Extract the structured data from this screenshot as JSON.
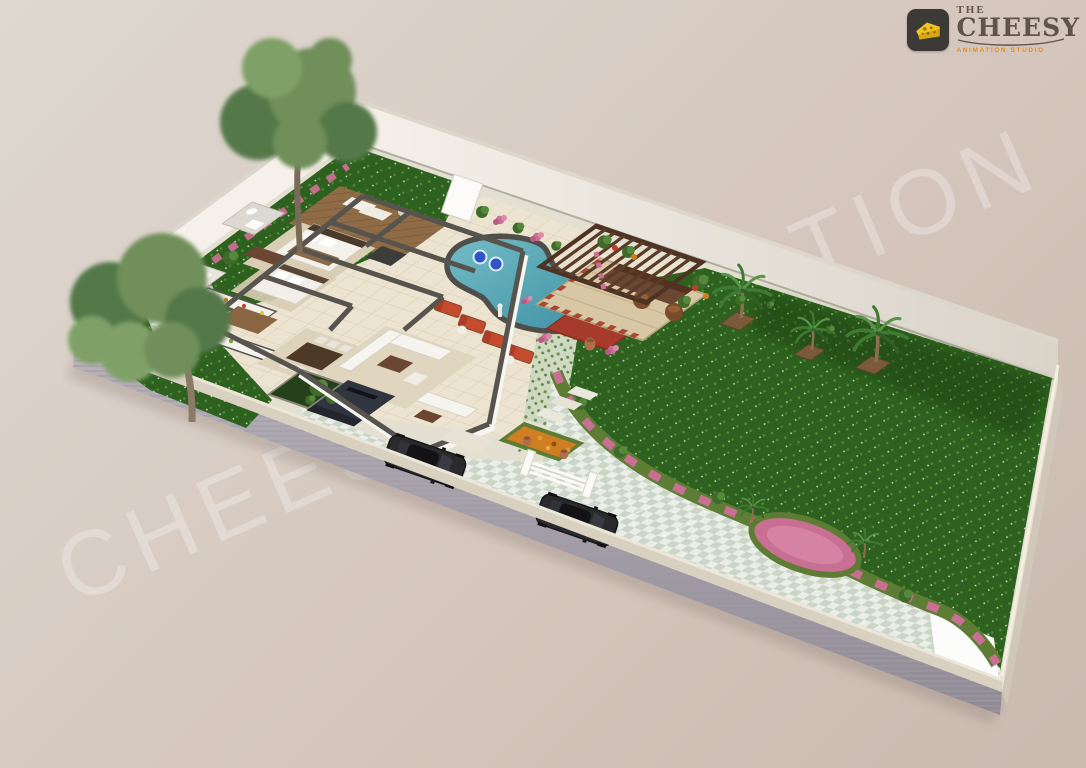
{
  "watermark": {
    "text": "CHEESY ANIMATION"
  },
  "logo": {
    "word_top": "THE",
    "brand": "CHEESY",
    "tagline": "ANIMATION STUDIO",
    "icon": "cheese-icon"
  },
  "palette": {
    "bg1": "#ded8d0",
    "bg2": "#d5c7bd",
    "bg3": "#c9bab0",
    "wm": "#ffffff",
    "wallFace": "#f5f1ea",
    "wallFaceShade": "#d9d3c8",
    "wallCap": "#dcd6cb",
    "plotBase": "#e3e0d2",
    "curb": "#d8d1c0",
    "platform": "#ada7b0",
    "platformSE": "#cfc8ba",
    "lawn": "#2e611f",
    "lawnDot": "#4f8f33",
    "lawnSpark": "#cfe0c2",
    "checkA": "#e9eee6",
    "checkB": "#ccd6c8",
    "cream": "#ece4d0",
    "creamLine": "#dcd2ba",
    "wood": "#8f6c46",
    "woodLine": "#77573a",
    "water1": "#73bcc6",
    "water2": "#3d8fa3",
    "coping": "#504e4a",
    "wall": "#57544e",
    "whiteWall": "#f7f5f0",
    "redTile": "#a63b2b",
    "terracotta": "#b06f49",
    "lounger": "#c44b2e",
    "pergolaWood": "#5a3c2a",
    "hedge": "#5d7d35",
    "pinkFlower": "#c96f93",
    "pinkFlowerLight": "#d98ca8",
    "orangeFlower": "#cf7e22",
    "carBody": "#2a2a2c",
    "carGlass": "#3a3d44",
    "treeG1": "#6f8f5a",
    "treeG2": "#55784a",
    "treeG3": "#7fa167",
    "palm": "#3f7a33",
    "rug": "#d9cdb4",
    "brownWood": "#6b4632",
    "logoBadge": "#3b3a36",
    "cheese": "#f2c21e",
    "brandText": "#5f544a",
    "tagline": "#df8f1e"
  },
  "scene": {
    "type": "3d-floor-plan",
    "subject": "Aerial 3D landscape floor plan of a villa plot",
    "features": [
      "white boundary walls",
      "large lawn",
      "kidney-shaped swimming pool",
      "pool floats",
      "red sun loungers",
      "wooden pergola lounge",
      "palm trees in planters",
      "two large shade trees",
      "pink flower borders",
      "oval flower island",
      "checkered paved walkway",
      "driveway with two parked cars",
      "white garden gate",
      "stepping stones",
      "open-roof house with bedrooms, bathrooms, kitchen, dining and lounge",
      "wooden sun deck",
      "courtyard plants",
      "red mosaic patio with clay pots",
      "garden statue"
    ]
  }
}
